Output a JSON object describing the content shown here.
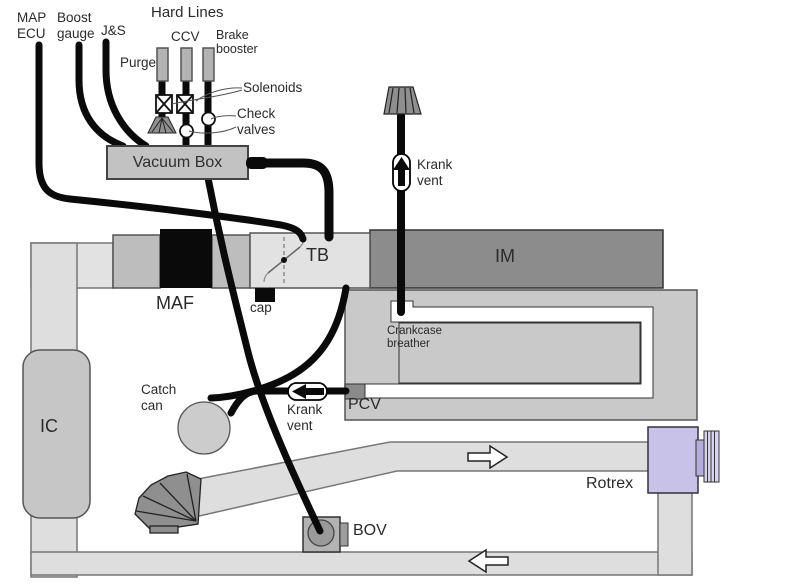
{
  "diagram": {
    "title": "Hard Lines",
    "labels": {
      "map_ecu": "MAP\nECU",
      "boost_gauge": "Boost\ngauge",
      "js": "J&S",
      "hard_lines": "Hard Lines",
      "purge": "Purge",
      "ccv": "CCV",
      "brake_booster": "Brake\nbooster",
      "solenoids": "Solenoids",
      "check_valves": "Check\nvalves",
      "vacuum_box": "Vacuum Box",
      "krank_vent_top": "Krank\nvent",
      "tb": "TB",
      "im": "IM",
      "maf": "MAF",
      "cap": "cap",
      "crankcase_breather": "Crankcase\nbreather",
      "ic": "IC",
      "catch_can": "Catch\ncan",
      "krank_vent_bottom": "Krank\nvent",
      "pcv": "PCV",
      "rotrex": "Rotrex",
      "bov": "BOV"
    },
    "flow_arrows": {
      "upper_pipe_direction": "right",
      "lower_pipe_direction": "left"
    },
    "colors": {
      "background": "#ffffff",
      "hose": "#0a0a0a",
      "pipe": "#dedede",
      "intake_tube": "#bdbdbd",
      "throttle_body": "#e2e2e2",
      "maf": "#0a0a0a",
      "intake_manifold": "#8c8c8c",
      "engine_block": "#c9c9c9",
      "breather_channel": "#ffffff",
      "vacuum_box": "#c2c2c2",
      "hard_line": "#b3b3b3",
      "filter": "#8f8f8f",
      "intercooler": "#c6c6c6",
      "catch_can": "#cccccc",
      "bov": "#b3b3b3",
      "pcv": "#8a8a8a",
      "rotrex": "#c8c1e8",
      "text": "#2a2a2a"
    }
  }
}
